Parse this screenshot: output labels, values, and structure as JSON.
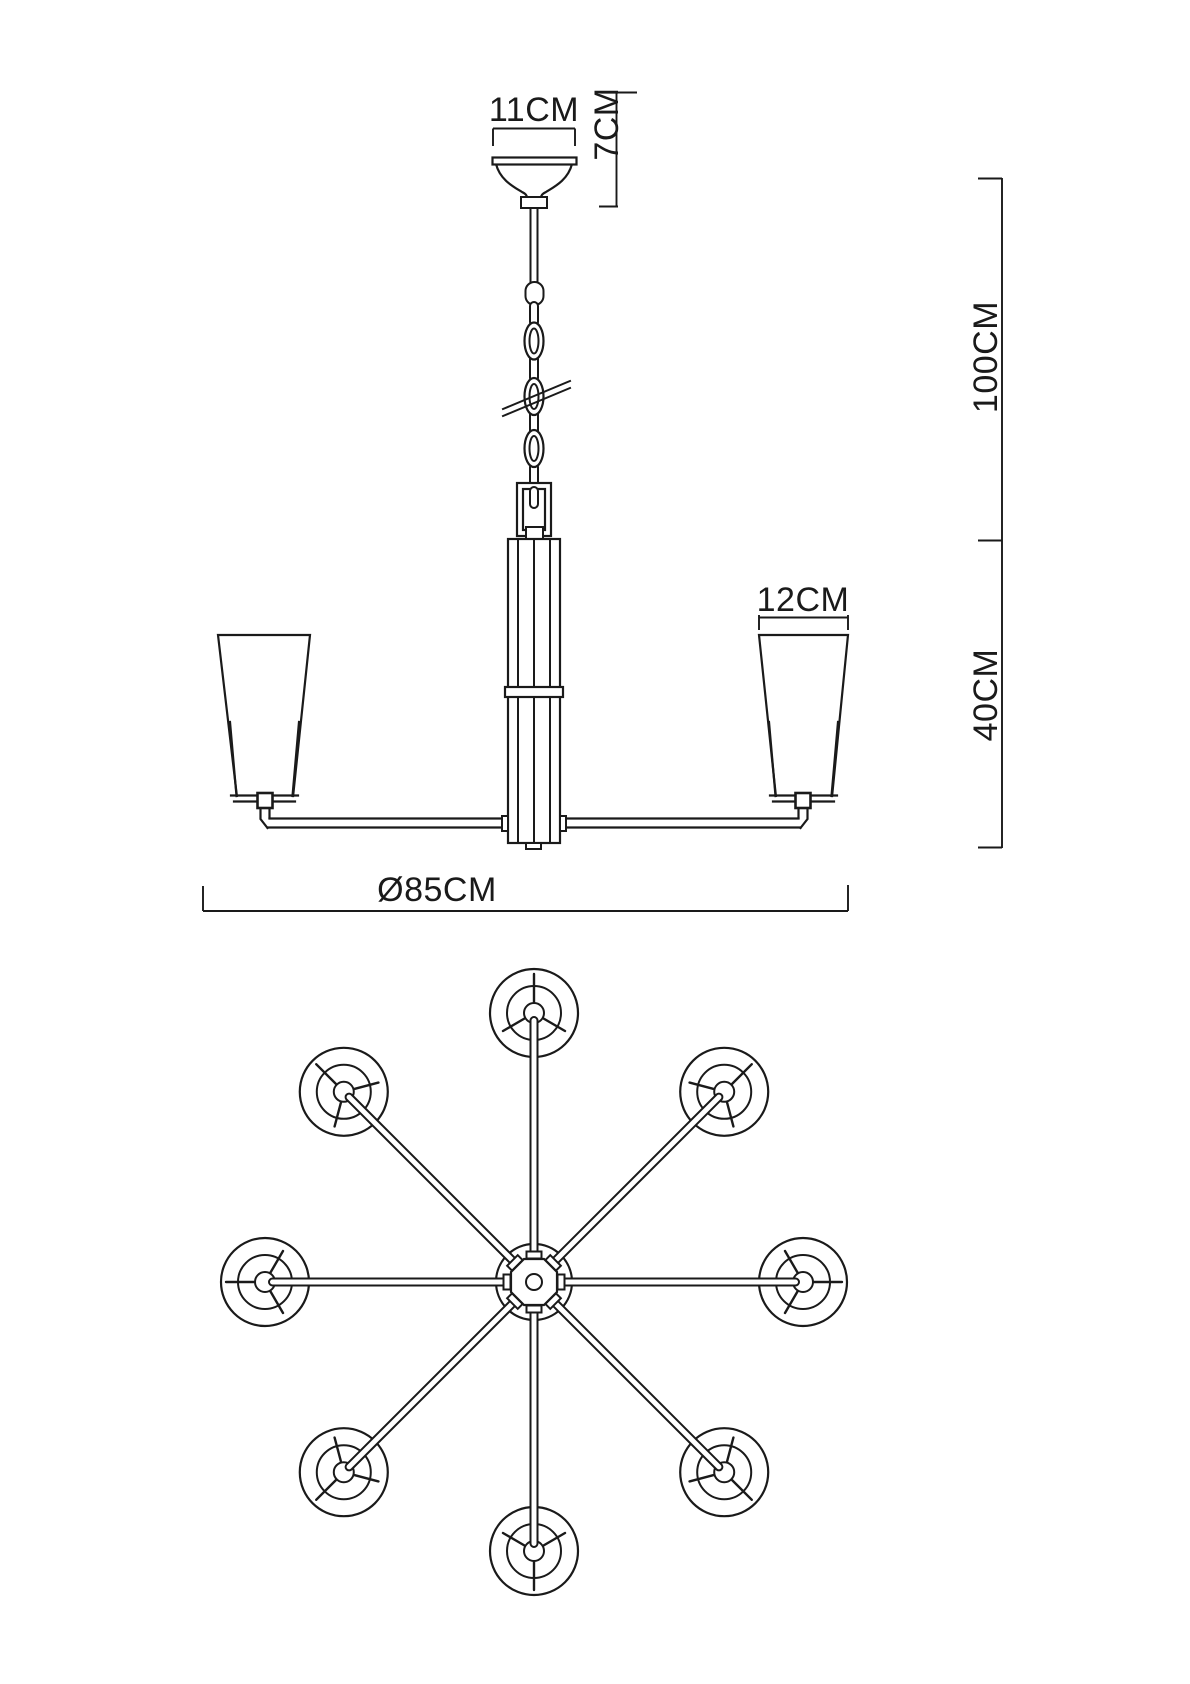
{
  "drawing": {
    "labels": {
      "canopy_width": "11CM",
      "canopy_height": "7CM",
      "suspension_length": "100CM",
      "body_height": "40CM",
      "shade_width": "12CM",
      "overall_diameter": "Ø85CM"
    },
    "colors": {
      "line": "#1a1a1a",
      "background": "#ffffff"
    }
  }
}
